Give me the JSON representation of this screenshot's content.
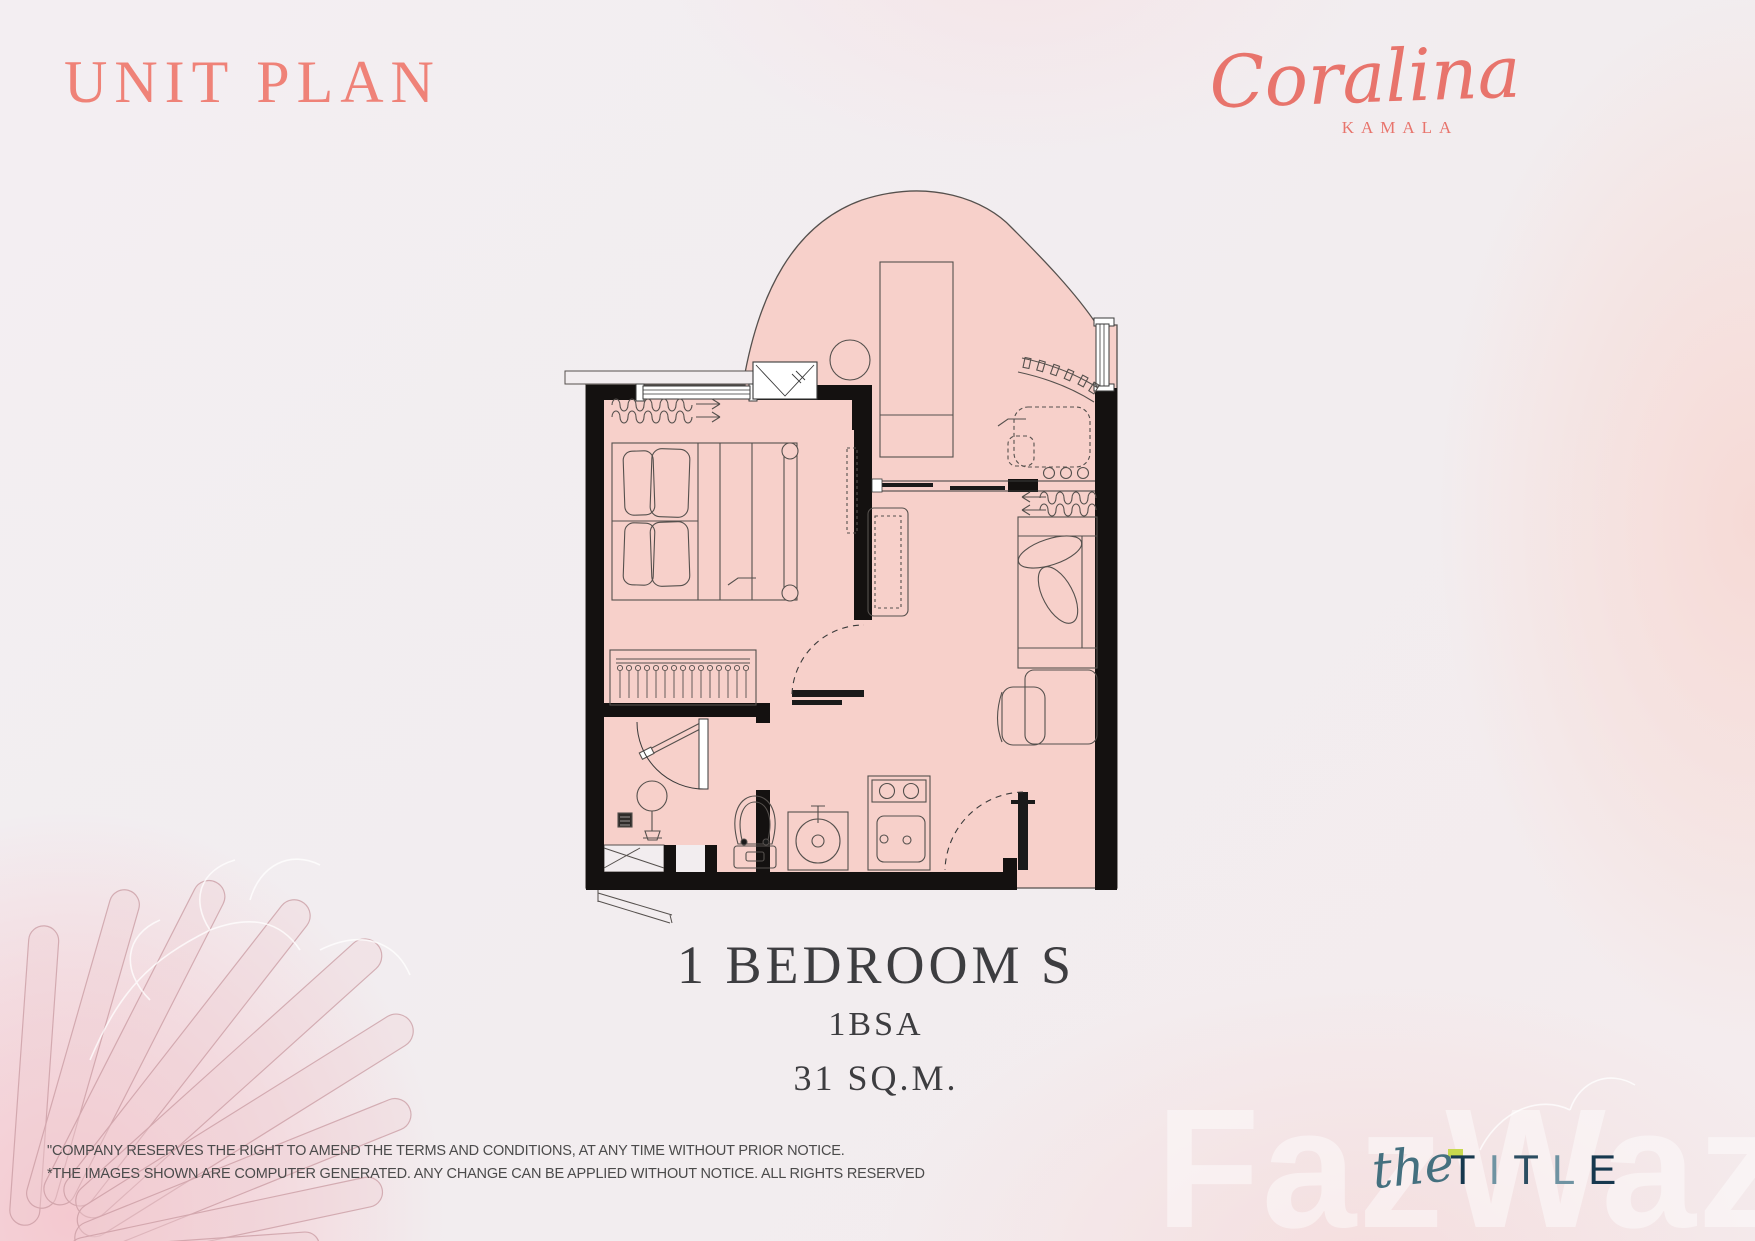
{
  "header": {
    "title": "UNIT PLAN"
  },
  "brand": {
    "name": "Coralina",
    "location": "KAMALA"
  },
  "unit": {
    "type": "1 BEDROOM S",
    "code": "1BSA",
    "area": "31 SQ.M."
  },
  "floor_plan": {
    "colors": {
      "unit_fill": "#f7d0ca",
      "wall": "#141110",
      "line": "#55504d",
      "background": "#f2edef",
      "title_coral": "#ef8278",
      "brand_coral": "#e8746c"
    }
  },
  "disclaimer": {
    "line1": "\"COMPANY RESERVES THE RIGHT TO AMEND THE TERMS AND CONDITIONS, AT ANY TIME WITHOUT PRIOR NOTICE.",
    "line2": "*THE IMAGES SHOWN ARE COMPUTER GENERATED. ANY CHANGE CAN BE APPLIED WITHOUT NOTICE. ALL RIGHTS RESERVED"
  },
  "developer": {
    "prefix": "the",
    "name": "TITLE",
    "accent": "#c8d84e",
    "letter_colors": [
      "#16384e",
      "#6f93a2",
      "#2b4d61",
      "#6f93a2",
      "#16384e"
    ]
  },
  "watermark": {
    "text": "FazWaz"
  }
}
